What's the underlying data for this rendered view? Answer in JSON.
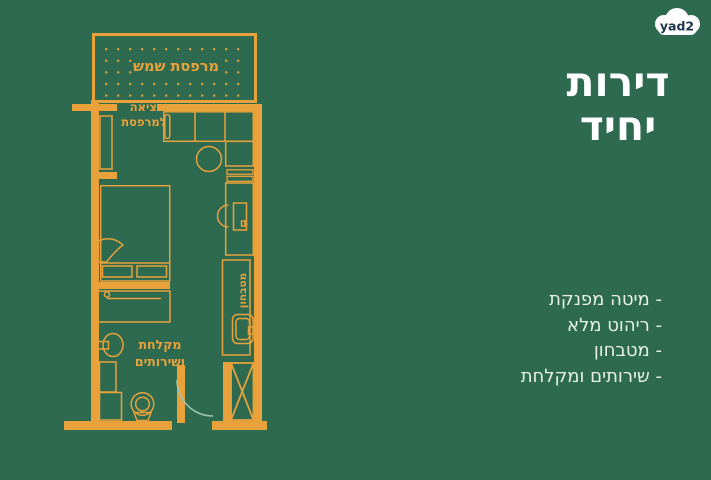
{
  "brand": {
    "logo_text": "yad2"
  },
  "title": {
    "line1": "דירות",
    "line2": "יחיד"
  },
  "features": [
    "- מיטה מפנקת",
    "- ריהוט מלא",
    "- מטבחון",
    "- שירותים ומקלחת"
  ],
  "plan": {
    "balcony_label": "מרפסת שמש",
    "balcony_exit_line1": "יציאה",
    "balcony_exit_line2": "למרפסת",
    "bathroom_line1": "מקלחת",
    "bathroom_line2": "ושירותים",
    "kitchenette_label": "מטבחון"
  },
  "colors": {
    "background": "#2d6a4f",
    "plan_accent": "#e9a23b",
    "door_arc": "#9cc4ae",
    "title_text": "#ffffff",
    "feature_text": "#e7f0e9",
    "logo_background": "#ffffff",
    "logo_text_color": "#21354e"
  }
}
